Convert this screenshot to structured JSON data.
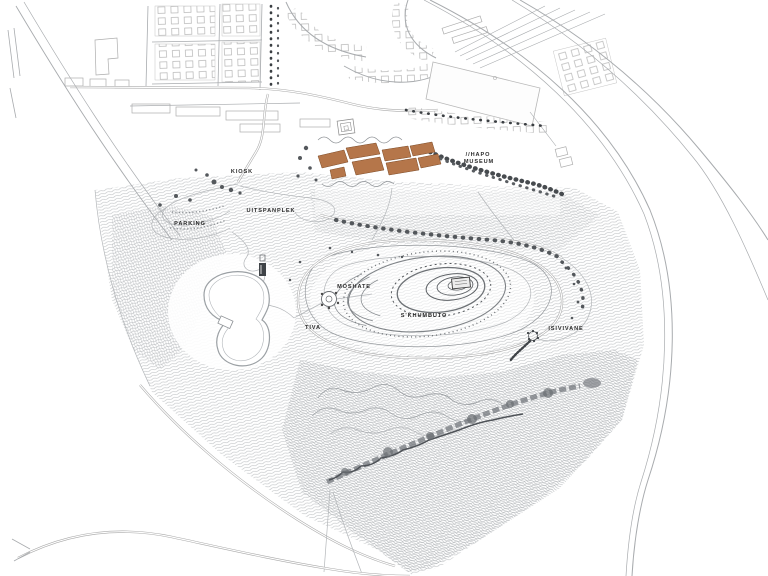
{
  "map": {
    "labels": {
      "kiosk": "KIOSK",
      "uitspanplek": "UITSPANPLEK",
      "parking": "PARKING",
      "hapo_line1": "//HAPO",
      "hapo_line2": "MUSEUM",
      "moshate": "MOSHATE",
      "skhumbuto": "S'KHUMBUTO",
      "tiva": "TIVA",
      "isivivane": "ISIVIVANE"
    },
    "colors": {
      "background": "#ffffff",
      "museum_buildings": "#b5764a",
      "museum_building_outline": "#7c4a26",
      "contour_line": "#a9adb1",
      "road_line": "#9b9b9b",
      "vegetation": "#46494d",
      "label_text": "#2b2b2b"
    }
  }
}
